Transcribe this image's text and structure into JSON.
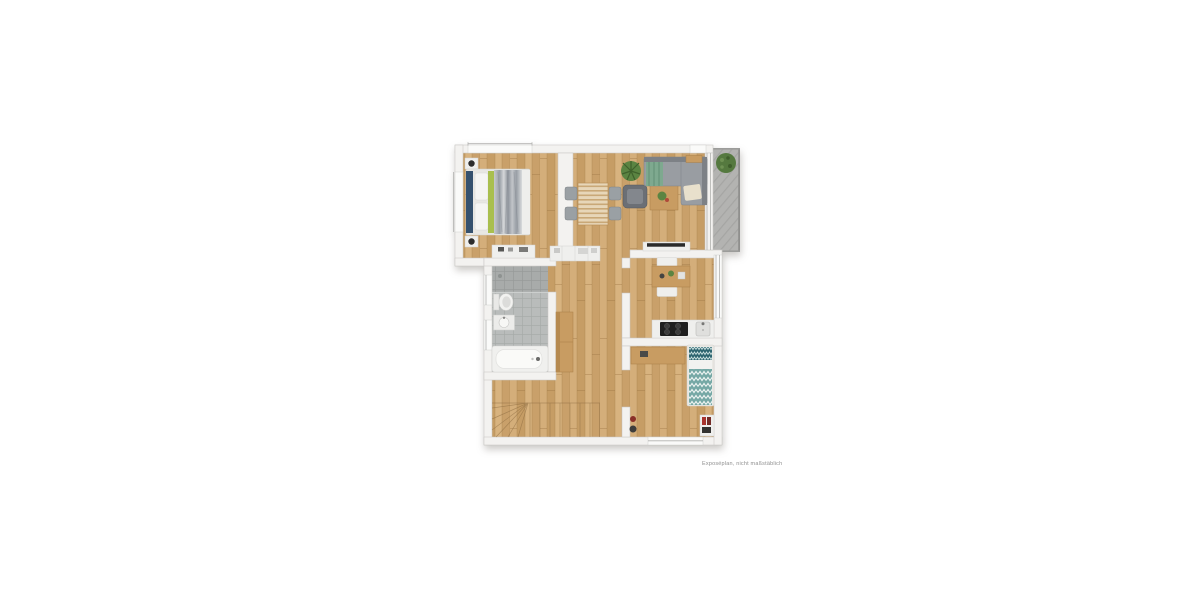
{
  "meta": {
    "disclaimer": "Exposéplan, nicht maßstäblich"
  },
  "palette": {
    "background": "#ffffff",
    "wall": "#f3f2f0",
    "wall-edge": "#c9c8c5",
    "wood-floor": "#cda671",
    "tile": "#b9bcbb",
    "balcony-deck": "#b3b3b1",
    "furniture-white": "#efefed",
    "wood-furniture": "#c89c62",
    "sofa-gray": "#999da2",
    "bed-headboard-blue": "#35516e",
    "bed-accent-green": "#a9bf4e",
    "single-bed-teal": "#75a8a5",
    "plant-green": "#55793f",
    "accent-red": "#a8342e",
    "cooktop-black": "#1f1f1f"
  }
}
